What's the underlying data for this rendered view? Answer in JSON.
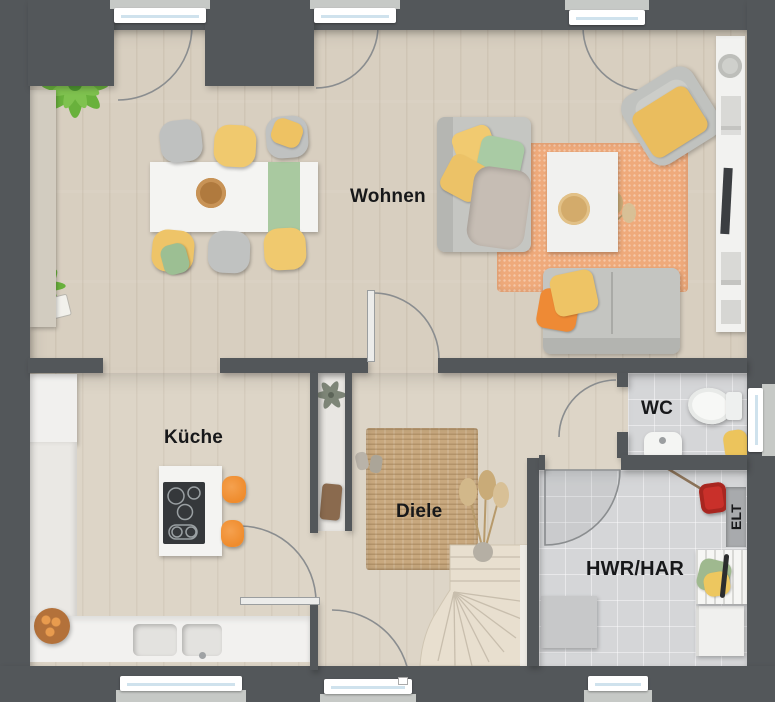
{
  "plan": {
    "title": "Erdgeschoss Grundriss",
    "type": "residential-floor-plan-top-view",
    "width_px": 775,
    "height_px": 702,
    "rooms": {
      "wohnen": {
        "label": "Wohnen"
      },
      "kueche": {
        "label": "Küche"
      },
      "diele": {
        "label": "Diele"
      },
      "wc": {
        "label": "WC"
      },
      "hwr": {
        "label": "HWR/HAR"
      },
      "elt": {
        "label": "ELT"
      }
    },
    "colors": {
      "wall": "#53575a",
      "exterior": "#616468",
      "wood_floor_living": "#d8cfc0",
      "wood_floor_hall": "#ddd5c7",
      "tile_floor": "#d5d6d8",
      "rug_living_orange": "#efaa7b",
      "rug_hall_jute": "#c8a87e",
      "accent_yellow": "#f0c568",
      "accent_green": "#a9cba2",
      "accent_orange": "#f08a2e",
      "laundry_basket_red": "#c9302a",
      "furniture_white": "#f3f3f1",
      "furniture_gray": "#c4c5c1",
      "window_frame": "#ffffff",
      "window_glass": "#cfe2ed",
      "label_text": "#17181a"
    },
    "furniture": {
      "wohnen": [
        "dining-table",
        "table-runner",
        "six-chairs",
        "sofa",
        "loveseat",
        "armchair",
        "coffee-table",
        "orange-rug",
        "tv-sideboard",
        "plant-fern",
        "sideboard"
      ],
      "kueche": [
        "tall-fridge-cabinet",
        "l-counter",
        "double-sink",
        "island-cooktop",
        "two-bar-stools",
        "fruit-bowl"
      ],
      "diele": [
        "jute-rug",
        "winder-staircase",
        "wardrobe-niche",
        "dried-grass-plant",
        "slippers",
        "front-door"
      ],
      "wc": [
        "toilet",
        "washbasin",
        "towel",
        "window"
      ],
      "hwr": [
        "washing-machine",
        "drying-rack",
        "laundry-basket-red",
        "mop",
        "gray-cabinet",
        "electrical-panel"
      ]
    }
  }
}
